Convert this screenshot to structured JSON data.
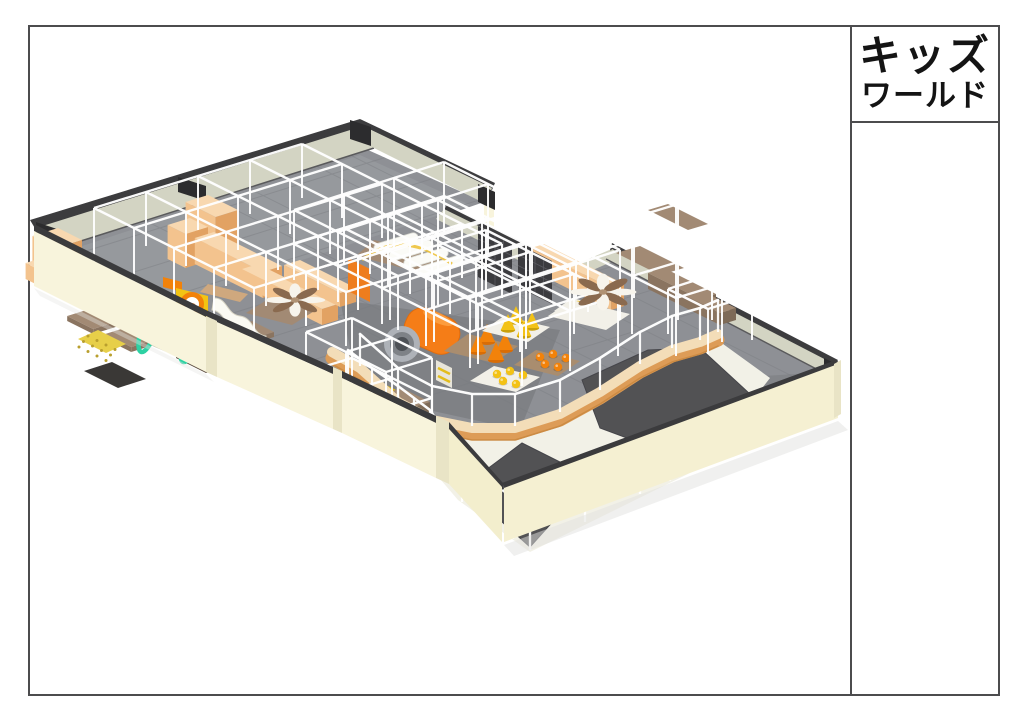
{
  "title_block": {
    "line1": "キッズ",
    "line2": "ワールド"
  },
  "sheet": {
    "border_color": "#4c4c4e",
    "background": "#ffffff"
  },
  "scene": {
    "description": "3D isometric render of an indoor kids playground floor plan",
    "palette": {
      "floor": "#8e9095",
      "floorLight": "#9a9ca1",
      "floorDark": "#737579",
      "tile": "#7a7c81",
      "wallTop": "#d3d4c3",
      "wallTopEdge": "#3c3c3e",
      "wallFace": "#f8f4dc",
      "wallFaceShade": "#e9e4c6",
      "wallFaceSE": "#f3eecd",
      "wallCap": "#3b3b3d",
      "black": "#2c2c2e",
      "frame": "#ffffff",
      "woodTop": "#f8d8b0",
      "wood": "#f3c38e",
      "woodDark": "#e2a263",
      "platform": "#a28a74",
      "platformDark": "#8a7460",
      "board": "#a98d6f",
      "boardWhite": "#f2f0e8",
      "mesh": "#3b3b3f",
      "orange": "#f2820a",
      "orangeDeep": "#d96d06",
      "yellow": "#f3c216",
      "yellowDeep": "#caa10a",
      "teal": "#2dd1a3",
      "slide": "#fbfaf3",
      "rollerBody": "#eae7d8",
      "rollerMat": "#3f5747",
      "barrel": "#f57d17",
      "court": "#f2f1e7",
      "trampoline": "#525254",
      "barrierTop": "#f3ddb8",
      "barrierSide": "#dd9c57",
      "barrierEdge": "#c8873f"
    }
  }
}
